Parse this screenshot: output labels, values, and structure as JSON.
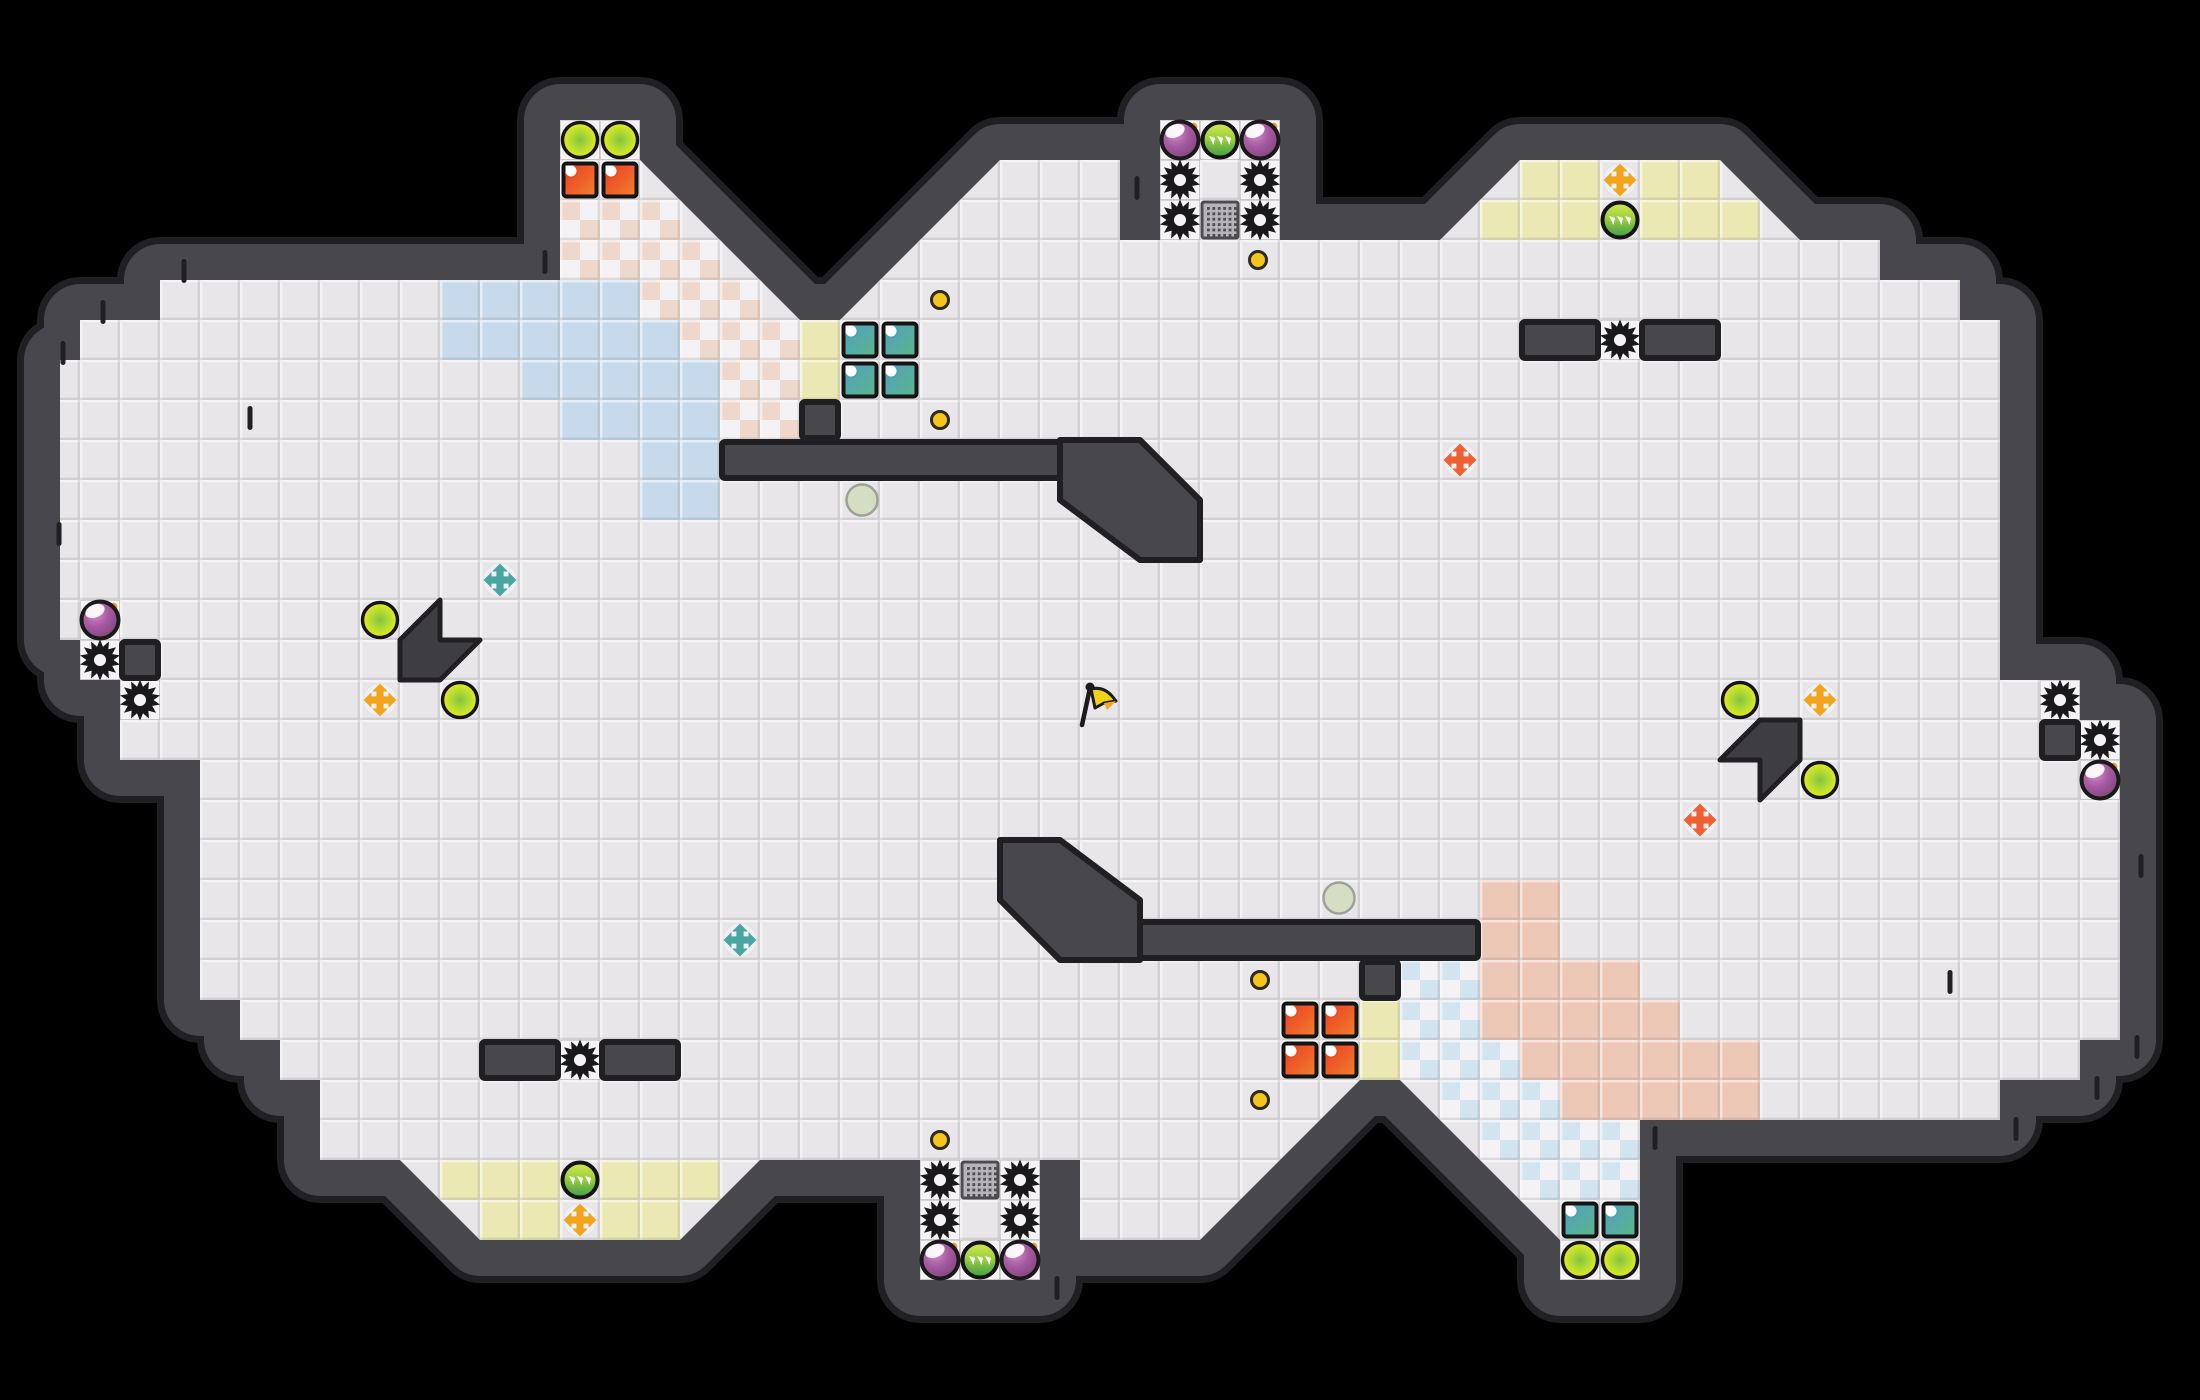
{
  "map": {
    "width": 2200,
    "height": 1400,
    "tile_size": 40,
    "colors": {
      "background": "#000000",
      "floor": "#e8e6e8",
      "floor_white": "#f5f3f5",
      "seam_light": "rgba(255,255,255,0.55)",
      "seam_dark": "rgba(95,90,95,0.16)",
      "wall": "#48484c",
      "wall_edge": "#202023",
      "arrow_fill": "#3e3e42",
      "blue_solid": "#c6daeb",
      "salmon_solid": "#eec8b7",
      "yellow_tile": "#ebe8b4",
      "checker_pink": "#eed8cb",
      "checker_blue": "#d3e4f1",
      "checker_white": "#f4f2f4",
      "grate_bg": "#b7b4b7",
      "grate_dot": "#4f4d52",
      "coin": "#f6c51c",
      "cross_orange": "#f3a41d",
      "cross_teal": "#4aa5a2",
      "cross_red": "#ee5f33",
      "sage": "#d5ddc2",
      "flag_yellow": "#f0d018",
      "flag_orange": "#f5a623"
    },
    "floor_polygon": [
      [
        160,
        280
      ],
      [
        560,
        280
      ],
      [
        560,
        120
      ],
      [
        640,
        120
      ],
      [
        640,
        160
      ],
      [
        800,
        320
      ],
      [
        840,
        320
      ],
      [
        1000,
        160
      ],
      [
        1060,
        160
      ],
      [
        1120,
        160
      ],
      [
        1120,
        240
      ],
      [
        1160,
        240
      ],
      [
        1160,
        120
      ],
      [
        1280,
        120
      ],
      [
        1280,
        240
      ],
      [
        1440,
        240
      ],
      [
        1520,
        160
      ],
      [
        1720,
        160
      ],
      [
        1800,
        240
      ],
      [
        1880,
        240
      ],
      [
        1880,
        280
      ],
      [
        1960,
        280
      ],
      [
        1960,
        320
      ],
      [
        2000,
        320
      ],
      [
        2000,
        680
      ],
      [
        2080,
        680
      ],
      [
        2080,
        720
      ],
      [
        2120,
        720
      ],
      [
        2120,
        1040
      ],
      [
        2080,
        1040
      ],
      [
        2080,
        1080
      ],
      [
        2000,
        1080
      ],
      [
        2000,
        1120
      ],
      [
        1760,
        1120
      ],
      [
        1640,
        1120
      ],
      [
        1640,
        1280
      ],
      [
        1560,
        1280
      ],
      [
        1560,
        1240
      ],
      [
        1400,
        1080
      ],
      [
        1360,
        1080
      ],
      [
        1200,
        1240
      ],
      [
        1140,
        1240
      ],
      [
        1080,
        1240
      ],
      [
        1080,
        1160
      ],
      [
        1040,
        1160
      ],
      [
        1040,
        1280
      ],
      [
        920,
        1280
      ],
      [
        920,
        1160
      ],
      [
        760,
        1160
      ],
      [
        680,
        1240
      ],
      [
        480,
        1240
      ],
      [
        400,
        1160
      ],
      [
        320,
        1160
      ],
      [
        320,
        1080
      ],
      [
        280,
        1080
      ],
      [
        280,
        1040
      ],
      [
        240,
        1040
      ],
      [
        240,
        1000
      ],
      [
        200,
        1000
      ],
      [
        200,
        760
      ],
      [
        120,
        760
      ],
      [
        120,
        680
      ],
      [
        80,
        680
      ],
      [
        80,
        640
      ],
      [
        60,
        640
      ],
      [
        60,
        360
      ],
      [
        80,
        360
      ],
      [
        80,
        320
      ],
      [
        160,
        320
      ]
    ],
    "wall_islands": {
      "rects": [
        [
          1520,
          320,
          80,
          40
        ],
        [
          1640,
          320,
          80,
          40
        ],
        [
          480,
          1040,
          80,
          40
        ],
        [
          600,
          1040,
          80,
          40
        ],
        [
          120,
          640,
          40,
          40
        ],
        [
          2040,
          720,
          40,
          40
        ],
        [
          800,
          400,
          40,
          40
        ],
        [
          720,
          440,
          360,
          40
        ],
        [
          1360,
          960,
          40,
          40
        ],
        [
          1120,
          920,
          360,
          40
        ]
      ],
      "arrows": [
        [
          [
            440,
            600
          ],
          [
            400,
            640
          ],
          [
            400,
            680
          ],
          [
            440,
            680
          ],
          [
            480,
            640
          ],
          [
            440,
            640
          ]
        ],
        [
          [
            1760,
            800
          ],
          [
            1800,
            760
          ],
          [
            1800,
            720
          ],
          [
            1760,
            720
          ],
          [
            1720,
            760
          ],
          [
            1760,
            760
          ]
        ]
      ],
      "tails": [
        [
          [
            1060,
            440
          ],
          [
            1140,
            440
          ],
          [
            1200,
            500
          ],
          [
            1200,
            560
          ],
          [
            1140,
            560
          ],
          [
            1060,
            500
          ]
        ],
        [
          [
            1140,
            960
          ],
          [
            1060,
            960
          ],
          [
            1000,
            900
          ],
          [
            1000,
            840
          ],
          [
            1060,
            840
          ],
          [
            1140,
            900
          ]
        ]
      ]
    },
    "wall_ticks": [
      [
        545,
        262
      ],
      [
        1137,
        188
      ],
      [
        250,
        418
      ],
      [
        1950,
        982
      ],
      [
        1057,
        1288
      ],
      [
        1655,
        1138
      ],
      [
        2016,
        1129
      ],
      [
        2097,
        1088
      ],
      [
        2137,
        1047
      ],
      [
        184,
        271
      ],
      [
        103,
        312
      ],
      [
        63,
        353
      ],
      [
        2141,
        866
      ],
      [
        59,
        534
      ]
    ],
    "regions": {
      "blue_solid": [
        [
          440,
          280
        ],
        [
          480,
          280
        ],
        [
          520,
          280
        ],
        [
          560,
          280
        ],
        [
          600,
          280
        ],
        [
          440,
          320
        ],
        [
          480,
          320
        ],
        [
          520,
          320
        ],
        [
          560,
          320
        ],
        [
          600,
          320
        ],
        [
          640,
          320
        ],
        [
          520,
          360
        ],
        [
          560,
          360
        ],
        [
          600,
          360
        ],
        [
          640,
          360
        ],
        [
          680,
          360
        ],
        [
          560,
          400
        ],
        [
          600,
          400
        ],
        [
          640,
          400
        ],
        [
          680,
          400
        ],
        [
          640,
          440
        ],
        [
          680,
          440
        ],
        [
          640,
          480
        ],
        [
          680,
          480
        ]
      ],
      "salmon_solid": [
        [
          1560,
          1080
        ],
        [
          1600,
          1080
        ],
        [
          1640,
          1080
        ],
        [
          1680,
          1080
        ],
        [
          1720,
          1080
        ],
        [
          1520,
          1040
        ],
        [
          1560,
          1040
        ],
        [
          1600,
          1040
        ],
        [
          1640,
          1040
        ],
        [
          1680,
          1040
        ],
        [
          1720,
          1040
        ],
        [
          1480,
          1000
        ],
        [
          1520,
          1000
        ],
        [
          1560,
          1000
        ],
        [
          1600,
          1000
        ],
        [
          1640,
          1000
        ],
        [
          1480,
          960
        ],
        [
          1520,
          960
        ],
        [
          1560,
          960
        ],
        [
          1600,
          960
        ],
        [
          1480,
          920
        ],
        [
          1520,
          920
        ],
        [
          1480,
          880
        ],
        [
          1520,
          880
        ]
      ],
      "yellow": [
        [
          800,
          320
        ],
        [
          800,
          360
        ],
        [
          1360,
          1000
        ],
        [
          1360,
          1040
        ],
        [
          1520,
          160
        ],
        [
          1560,
          160
        ],
        [
          1640,
          160
        ],
        [
          1680,
          160
        ],
        [
          1480,
          200
        ],
        [
          1520,
          200
        ],
        [
          1560,
          200
        ],
        [
          1640,
          200
        ],
        [
          1680,
          200
        ],
        [
          1720,
          200
        ],
        [
          440,
          1160
        ],
        [
          480,
          1160
        ],
        [
          520,
          1160
        ],
        [
          600,
          1160
        ],
        [
          640,
          1160
        ],
        [
          680,
          1160
        ],
        [
          480,
          1200
        ],
        [
          520,
          1200
        ],
        [
          600,
          1200
        ],
        [
          640,
          1200
        ]
      ],
      "checker_pink": [
        [
          560,
          200
        ],
        [
          600,
          200
        ],
        [
          640,
          200
        ],
        [
          560,
          240
        ],
        [
          600,
          240
        ],
        [
          640,
          240
        ],
        [
          680,
          240
        ],
        [
          640,
          280
        ],
        [
          680,
          280
        ],
        [
          720,
          280
        ],
        [
          680,
          320
        ],
        [
          720,
          320
        ],
        [
          760,
          320
        ],
        [
          720,
          360
        ],
        [
          760,
          360
        ],
        [
          720,
          400
        ],
        [
          760,
          400
        ]
      ],
      "checker_blue": [
        [
          1520,
          1160
        ],
        [
          1560,
          1160
        ],
        [
          1600,
          1160
        ],
        [
          1480,
          1120
        ],
        [
          1520,
          1120
        ],
        [
          1560,
          1120
        ],
        [
          1600,
          1120
        ],
        [
          1440,
          1080
        ],
        [
          1480,
          1080
        ],
        [
          1520,
          1080
        ],
        [
          1400,
          1040
        ],
        [
          1440,
          1040
        ],
        [
          1480,
          1040
        ],
        [
          1400,
          1000
        ],
        [
          1440,
          1000
        ],
        [
          1400,
          960
        ],
        [
          1440,
          960
        ]
      ],
      "white_tiles": [
        [
          560,
          120
        ],
        [
          600,
          120
        ],
        [
          1160,
          120
        ],
        [
          1200,
          120
        ],
        [
          1240,
          120
        ],
        [
          1160,
          160
        ],
        [
          1240,
          160
        ],
        [
          1160,
          200
        ],
        [
          1240,
          200
        ],
        [
          1600,
          320
        ],
        [
          80,
          600
        ],
        [
          80,
          640
        ],
        [
          120,
          680
        ],
        [
          2040,
          680
        ],
        [
          2080,
          720
        ],
        [
          2080,
          760
        ],
        [
          560,
          1040
        ],
        [
          920,
          1160
        ],
        [
          1000,
          1160
        ],
        [
          920,
          1200
        ],
        [
          1000,
          1200
        ],
        [
          920,
          1240
        ],
        [
          960,
          1240
        ],
        [
          1000,
          1240
        ],
        [
          1560,
          1240
        ],
        [
          1600,
          1240
        ]
      ]
    }
  },
  "items": {
    "gears": [
      [
        1180,
        180
      ],
      [
        1260,
        180
      ],
      [
        1180,
        220
      ],
      [
        1260,
        220
      ],
      [
        940,
        1180
      ],
      [
        1020,
        1180
      ],
      [
        940,
        1220
      ],
      [
        1020,
        1220
      ],
      [
        1620,
        340
      ],
      [
        580,
        1060
      ],
      [
        100,
        660
      ],
      [
        140,
        700
      ],
      [
        2060,
        700
      ],
      [
        2100,
        740
      ]
    ],
    "bombs": [
      [
        100,
        620
      ],
      [
        1180,
        140
      ],
      [
        1260,
        140
      ],
      [
        940,
        1260
      ],
      [
        1020,
        1260
      ],
      [
        2100,
        780
      ]
    ],
    "spike_orbs": [
      [
        1220,
        140
      ],
      [
        1620,
        220
      ],
      [
        580,
        1180
      ],
      [
        980,
        1260
      ]
    ],
    "pickups_backed": [
      [
        580,
        140
      ],
      [
        620,
        140
      ],
      [
        1580,
        1260
      ],
      [
        1620,
        1260
      ]
    ],
    "pickups_field": [
      [
        380,
        620
      ],
      [
        460,
        700
      ],
      [
        1740,
        700
      ],
      [
        1820,
        780
      ]
    ],
    "coins": [
      [
        940,
        300
      ],
      [
        940,
        420
      ],
      [
        1258,
        260
      ],
      [
        940,
        1140
      ],
      [
        1260,
        980
      ],
      [
        1260,
        1100
      ]
    ],
    "crosses": [
      {
        "x": 380,
        "y": 700,
        "c": "orange"
      },
      {
        "x": 1820,
        "y": 700,
        "c": "orange"
      },
      {
        "x": 1620,
        "y": 180,
        "c": "orange"
      },
      {
        "x": 580,
        "y": 1220,
        "c": "orange"
      },
      {
        "x": 500,
        "y": 580,
        "c": "teal"
      },
      {
        "x": 740,
        "y": 940,
        "c": "teal"
      },
      {
        "x": 1460,
        "y": 460,
        "c": "red"
      },
      {
        "x": 1700,
        "y": 820,
        "c": "red"
      }
    ],
    "blocks_red": [
      [
        560,
        160
      ],
      [
        600,
        160
      ],
      [
        1280,
        1000
      ],
      [
        1320,
        1000
      ],
      [
        1280,
        1040
      ],
      [
        1320,
        1040
      ]
    ],
    "blocks_teal": [
      [
        840,
        320
      ],
      [
        880,
        320
      ],
      [
        840,
        360
      ],
      [
        880,
        360
      ],
      [
        1560,
        1200
      ],
      [
        1600,
        1200
      ]
    ],
    "grates": [
      [
        1200,
        200
      ],
      [
        960,
        1160
      ]
    ],
    "sage_circles": [
      [
        862,
        500
      ],
      [
        1339,
        898
      ]
    ],
    "flag": {
      "x": 1083,
      "y": 705
    }
  }
}
